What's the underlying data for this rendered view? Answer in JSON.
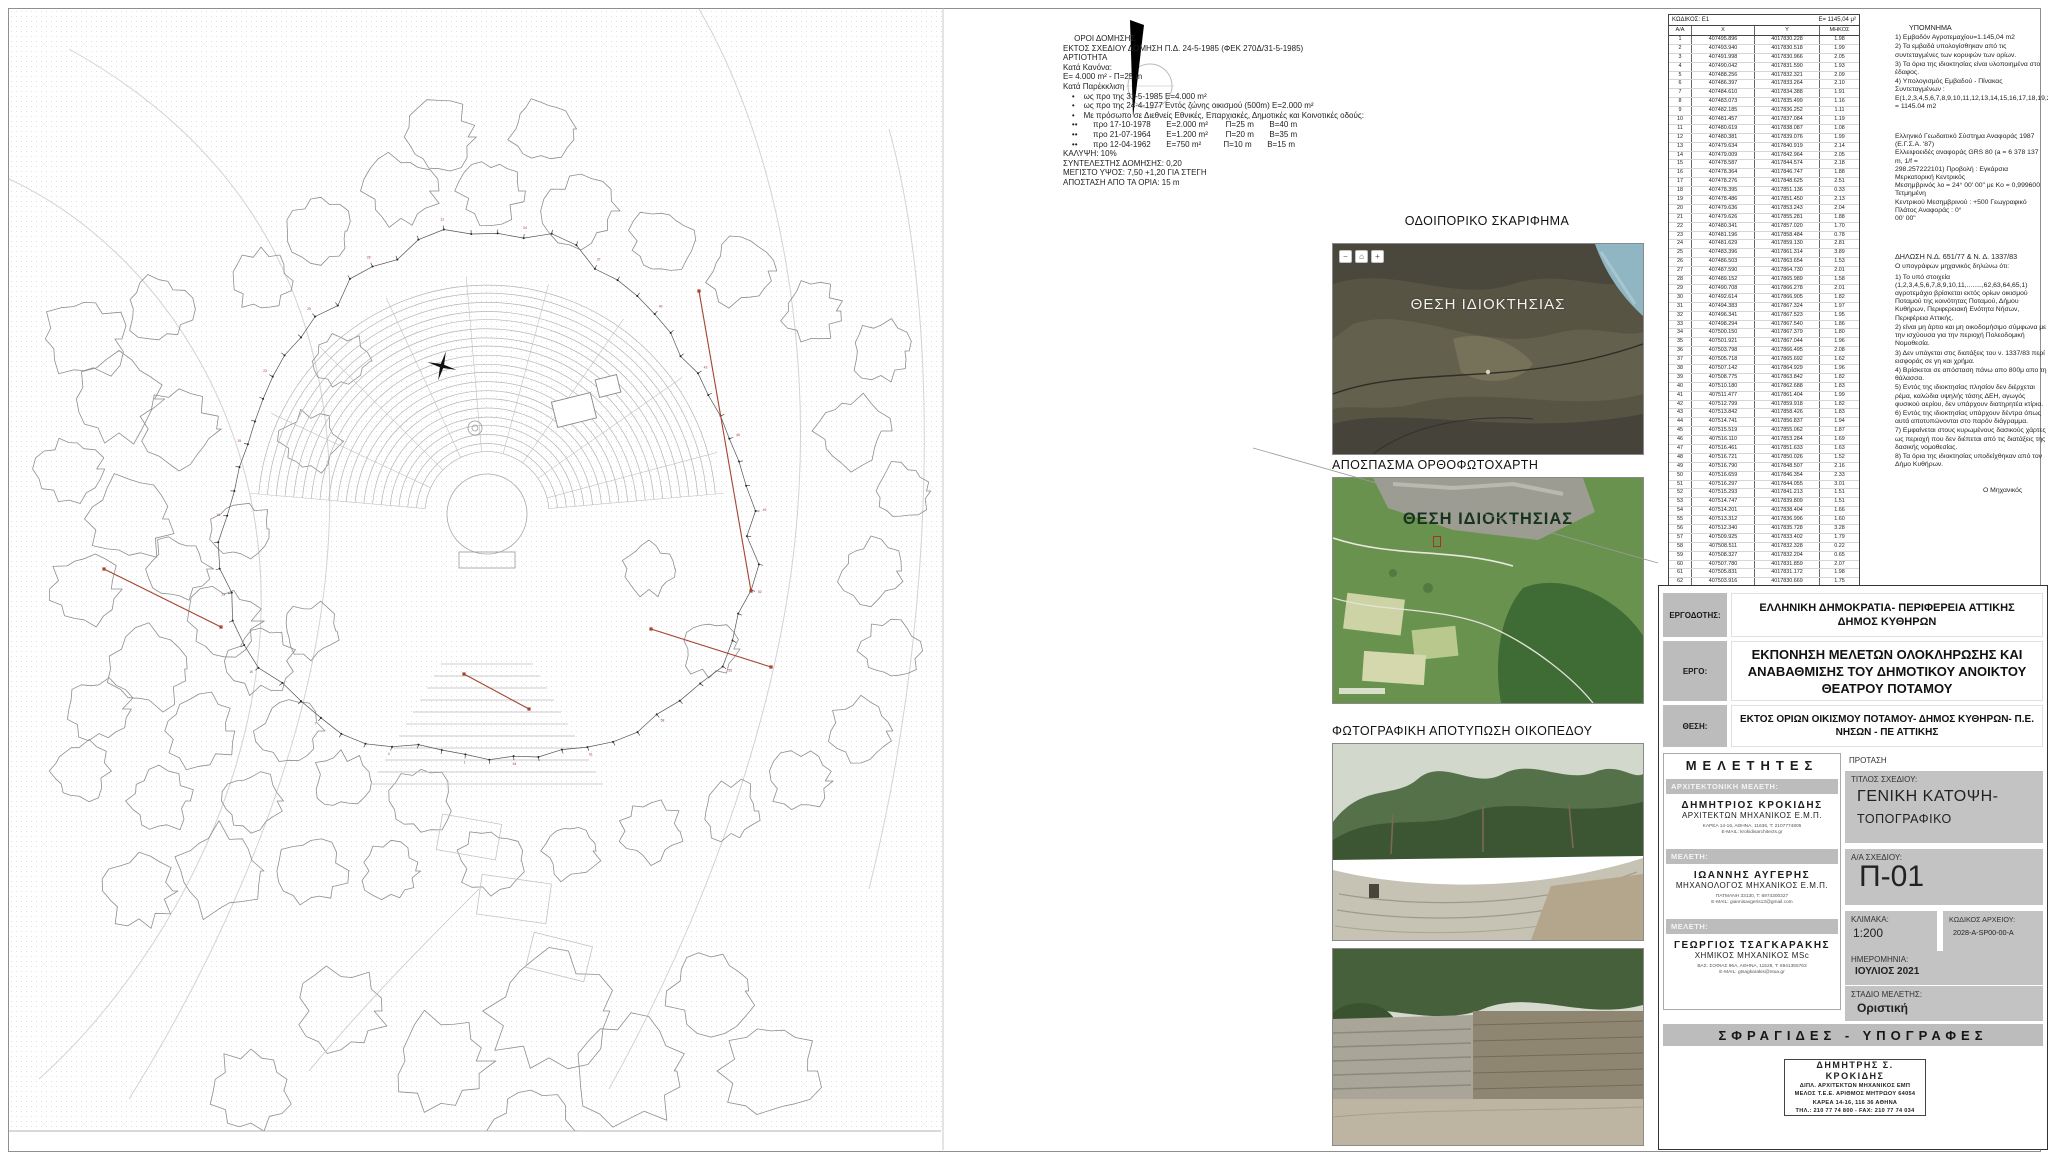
{
  "regulations": {
    "lines": [
      "     ΟΡΟΙ ΔΟΜΗΣΗΣ",
      "ΕΚΤΟΣ ΣΧΕΔΙΟΥ ΔΟΜΗΣΗ Π.Δ. 24-5-1985 (ΦΕΚ 270Δ/31-5-1985)",
      "ΑΡΤΙΟΤΗΤΑ",
      "Κατά Κανόνα:",
      "Ε= 4.000 m² - Π=25 m",
      "Κατά Παρέκκλιση",
      "    •    ως προ της 31-5-1985 Ε=4.000 m²",
      "    •    ως προ της 24-4-1977 Εντός ζώνης οικισμού (500m) Ε=2.000 m²",
      "    •    Με πρόσωπο σε Διεθνείς Εθνικές, Επαρχιακές, Δημοτικές και Κοινοτικές οδούς:",
      "    ••       προ 17-10-1978       Ε=2.000 m²        Π=25 m       Β=40 m",
      "    ••       προ 21-07-1964       Ε=1.200 m²        Π=20 m       Β=35 m",
      "    ••       προ 12-04-1962       Ε=750 m²          Π=10 m       Β=15 m",
      "",
      "ΚΑΛΥΨΗ: 10%",
      "",
      "ΣΥΝΤΕΛΕΣΤΗΣ ΔΟΜΗΣΗΣ: 0,20",
      "",
      "ΜΕΓΙΣΤΟ ΥΨΟΣ: 7,50 +1,20 ΓΙΑ ΣΤΕΓΗ",
      "",
      "ΑΠΟΣΤΑΣΗ ΑΠΟ ΤΑ ΟΡΙΑ: 15 m"
    ]
  },
  "coords_table": {
    "code_label": "ΚΩΔΙΚΟΣ: Ε1",
    "area_label": "Ε= 1145,04 μ²",
    "columns": [
      "Α/Α",
      "Χ",
      "Υ",
      "ΜΗΚΟΣ"
    ],
    "rows": [
      [
        "1",
        "407495.896",
        "4017830.228",
        "1.98"
      ],
      [
        "2",
        "407493.940",
        "4017830.518",
        "1.99"
      ],
      [
        "3",
        "407491.998",
        "4017830.966",
        "2.05"
      ],
      [
        "4",
        "407490.042",
        "4017831.590",
        "1.93"
      ],
      [
        "5",
        "407488.256",
        "4017832.321",
        "2.09"
      ],
      [
        "6",
        "407486.397",
        "4017833.264",
        "2.10"
      ],
      [
        "7",
        "407484.610",
        "4017834.388",
        "1.91"
      ],
      [
        "8",
        "407483.073",
        "4017835.499",
        "1.16"
      ],
      [
        "9",
        "407482.185",
        "4017836.252",
        "1.11"
      ],
      [
        "10",
        "407481.457",
        "4017837.084",
        "1.19"
      ],
      [
        "11",
        "407480.619",
        "4017838.087",
        "1.08"
      ],
      [
        "12",
        "407480.381",
        "4017839.076",
        "1.99"
      ],
      [
        "13",
        "407479.634",
        "4017840.919",
        "2.14"
      ],
      [
        "14",
        "407479.009",
        "4017842.964",
        "2.05"
      ],
      [
        "15",
        "407478.587",
        "4017844.574",
        "2.18"
      ],
      [
        "16",
        "407478.364",
        "4017846.747",
        "1.88"
      ],
      [
        "17",
        "407478.276",
        "4017848.625",
        "2.51"
      ],
      [
        "18",
        "407478.395",
        "4017851.136",
        "0.33"
      ],
      [
        "19",
        "407478.486",
        "4017851.450",
        "2.13"
      ],
      [
        "20",
        "407479.636",
        "4017853.243",
        "2.04"
      ],
      [
        "21",
        "407479.626",
        "4017855.281",
        "1.88"
      ],
      [
        "22",
        "407480.341",
        "4017857.020",
        "1.70"
      ],
      [
        "23",
        "407481.196",
        "4017858.484",
        "0.78"
      ],
      [
        "24",
        "407481.629",
        "4017859.130",
        "2.81"
      ],
      [
        "25",
        "407483.396",
        "4017861.314",
        "3.89"
      ],
      [
        "26",
        "407486.503",
        "4017863.654",
        "1.53"
      ],
      [
        "27",
        "407487.590",
        "4017864.730",
        "2.01"
      ],
      [
        "28",
        "407489.152",
        "4017865.989",
        "1.58"
      ],
      [
        "29",
        "407490.708",
        "4017866.278",
        "2.01"
      ],
      [
        "30",
        "407492.614",
        "4017866.905",
        "1.82"
      ],
      [
        "31",
        "407494.383",
        "4017867.324",
        "1.97"
      ],
      [
        "32",
        "407496.341",
        "4017867.523",
        "1.95"
      ],
      [
        "33",
        "407498.294",
        "4017867.540",
        "1.86"
      ],
      [
        "34",
        "407500.150",
        "4017867.379",
        "1.80"
      ],
      [
        "35",
        "407501.921",
        "4017867.044",
        "1.96"
      ],
      [
        "36",
        "407503.798",
        "4017866.495",
        "2.08"
      ],
      [
        "37",
        "407505.718",
        "4017865.692",
        "1.62"
      ],
      [
        "38",
        "407507.142",
        "4017864.929",
        "1.96"
      ],
      [
        "39",
        "407508.775",
        "4017863.842",
        "1.82"
      ],
      [
        "40",
        "407510.180",
        "4017862.688",
        "1.83"
      ],
      [
        "41",
        "407511.477",
        "4017861.404",
        "1.99"
      ],
      [
        "42",
        "407512.799",
        "4017859.918",
        "1.82"
      ],
      [
        "43",
        "407513.842",
        "4017858.426",
        "1.83"
      ],
      [
        "44",
        "407514.741",
        "4017856.837",
        "1.94"
      ],
      [
        "45",
        "407515.519",
        "4017855.062",
        "1.87"
      ],
      [
        "46",
        "407516.110",
        "4017853.284",
        "1.69"
      ],
      [
        "47",
        "407516.461",
        "4017851.633",
        "1.63"
      ],
      [
        "48",
        "407516.721",
        "4017850.026",
        "1.52"
      ],
      [
        "49",
        "407516.790",
        "4017848.507",
        "2.16"
      ],
      [
        "50",
        "407516.659",
        "4017846.354",
        "2.33"
      ],
      [
        "51",
        "407516.297",
        "4017844.055",
        "3.01"
      ],
      [
        "52",
        "407515.293",
        "4017841.213",
        "1.51"
      ],
      [
        "53",
        "407514.747",
        "4017839.809",
        "1.51"
      ],
      [
        "54",
        "407514.201",
        "4017838.404",
        "1.66"
      ],
      [
        "55",
        "407513.312",
        "4017836.996",
        "1.60"
      ],
      [
        "56",
        "407512.340",
        "4017835.728",
        "3.28"
      ],
      [
        "57",
        "407509.925",
        "4017833.402",
        "1.79"
      ],
      [
        "58",
        "407508.511",
        "4017832.328",
        "0.22"
      ],
      [
        "59",
        "407508.327",
        "4017832.204",
        "0.65"
      ],
      [
        "60",
        "407507.780",
        "4017831.859",
        "2.07"
      ],
      [
        "61",
        "407505.831",
        "4017831.172",
        "1.98"
      ],
      [
        "62",
        "407503.916",
        "4017830.669",
        "1.75"
      ],
      [
        "63",
        "407502.194",
        "4017830.352",
        "2.17"
      ],
      [
        "64",
        "407500.040",
        "4017830.129",
        "2.02"
      ],
      [
        "65",
        "407498.016",
        "4017830.001",
        "2.13"
      ]
    ]
  },
  "legend": {
    "title": "ΥΠΟΜΝΗΜΑ",
    "items": [
      "1)  Εμβαδόν Αγροτεμαχίου=1.145,04 m2",
      "2)  Τα εμβαδά υπολογίσθηκαν από τις συντεταγμένες των κορυφών των ορίων.",
      "3)  Τα όρια της ιδιοκτησίας είναι υλοποιημένα στο έδαφος.",
      "4)  Υπολογισμός Εμβαδού - Πίνακας Συντεταγμένων : Ε(1,2,3,4,5,6,7,8,9,10,11,12,13,14,15,16,17,18,19,20,21,22,23,24,25,26,27,28,29,30,31,32,33,34,35,36,37,38,39,40,41,42,43,44,45,46,47,48,49,50,51,52,53,54,55,56,57,58,59,60,61,62,63,64,65,1) = 1145.04 m2"
    ]
  },
  "geodetic": {
    "lines": [
      "Ελληνικό Γεωδαιτικό Σύστημα Αναφοράς 1987 (Ε.Γ.Σ.Α. '87)",
      "Ελλειψοειδές αναφοράς GRS 80 (a = 6 378 137 m, 1/f =",
      "298.257222101) Προβολή : Εγκάρσια Μερκατορική Κεντρικός",
      "Μεσημβρινός λο = 24° 00' 00\" με Κο = 0,999600 Τετμημένη",
      "Κεντρικού Μεσημβρινού : +500 Γεωγραφικό Πλάτος Αναφοράς : 0°",
      "00' 00\""
    ]
  },
  "declaration": {
    "title": "ΔΗΛΩΣΗ Ν.Δ. 651/77 & Ν. Δ. 1337/83",
    "intro": "Ο υπογράφων μηχανικός δηλώνω ότι:",
    "items": [
      "1)  Το υπό στοιχεία (1,2,3,4,5,6,7,8,9,10,11,........,62,63,64,65,1) αγροτεμάχιο βρίσκεται εκτός ορίων οικισμού Ποταμού της κοινότητας Ποταμού, Δήμου Κυθήρων, Περιφερειακή Ενότητα Νήσων, Περιφέρεια Αττικής.",
      "2)  είναι μη άρτιο και μη οικοδομήσιμο σύμφωνα με την ισχύουσα για την περιοχή Πολεοδομική Νομοθεσία.",
      "3)  Δεν υπάγεται στις διατάξεις του ν. 1337/83 περί εισφοράς σε γη και χρήμα.",
      "4)  Βρίσκεται σε απόσταση πάνω απο 800μ απο τη θάλασσα.",
      "5)  Εντός της ιδιοκτησίας πλησίον δεν διέρχεται ρέμα, καλώδια υψηλής τάσης ΔΕΗ, αγωγός φυσικού αερίου, δεν υπάρχουν διατηρητέα κτίρια.",
      "6)  Εντός της ιδιοκτησίας υπάρχουν δέντρα όπως αυτά αποτυπώνονται στο παρόν διάγραμμα.",
      "7)  Εμφαίνεται στους κυρωμένους δασικούς χάρτες ως περιοχή που δεν διέπεται από τις διατάξεις της δασικής νομοθεσίας.",
      "8)  Τα όρια της ιδιοκτησίας υποδείχθηκαν από τον Δήμο Κυθήρων."
    ],
    "signoff": "Ο  Μηχανικός"
  },
  "panels": {
    "sketch_label": "ΟΔΟΙΠΟΡΙΚΟ ΣΚΑΡΙΦΗΜΑ",
    "ortho_label": "ΑΠΟΣΠΑΣΜΑ ΟΡΘΟΦΩΤΟΧΑΡΤΗ",
    "photos_label": "ΦΩΤΟΓΡΑΦΙΚΗ ΑΠΟΤΥΠΩΣΗ ΟΙΚΟΠΕΔΟΥ",
    "site_label_sat": "ΘΕΣΗ ΙΔΙΟΚΤΗΣΙΑΣ",
    "site_label_ortho": "ΘΕΣΗ ΙΔΙΟΚΤΗΣΙΑΣ",
    "map_controls": [
      "−",
      "⌂",
      "+"
    ]
  },
  "titleblock": {
    "client_label": "ΕΡΓΟΔΟΤΗΣ:",
    "client_value_1": "ΕΛΛΗΝΙΚΗ ΔΗΜΟΚΡΑΤΙΑ- ΠΕΡΙΦΕΡΕΙΑ ΑΤΤΙΚΗΣ",
    "client_value_2": "ΔΗΜΟΣ ΚΥΘΗΡΩΝ",
    "project_label": "ΕΡΓΟ:",
    "project_value": "ΕΚΠΟΝΗΣΗ ΜΕΛΕΤΩΝ ΟΛΟΚΛΗΡΩΣΗΣ ΚΑΙ ΑΝΑΒΑΘΜΙΣΗΣ ΤΟΥ ΔΗΜΟΤΙΚΟΥ ΑΝΟΙΚΤΟΥ ΘΕΑΤΡΟΥ ΠΟΤΑΜΟΥ",
    "location_label": "ΘΕΣΗ:",
    "location_value": "ΕΚΤΟΣ ΟΡΙΩΝ ΟΙΚΙΣΜΟΥ ΠΟΤΑΜΟΥ- ΔΗΜΟΣ ΚΥΘΗΡΩΝ- Π.Ε. ΝΗΣΩΝ - ΠΕ ΑΤΤΙΚΗΣ",
    "designers": {
      "header": "ΜΕΛΕΤΗΤΕΣ",
      "entries": [
        {
          "role": "ΑΡΧΙΤΕΚΤΟΝΙΚΗ ΜΕΛΕΤΗ:",
          "name": "ΔΗΜΗΤΡΙΟΣ ΚΡΟΚΙΔΗΣ",
          "title": "ΑΡΧΙΤΕΚΤΩΝ ΜΗΧΑΝΙΚΟΣ Ε.Μ.Π.",
          "address": "ΚΑΡΕΑ 14-16, ΑΘΗΝΑ, 11636, Τ: 2107774805",
          "email": "E-MAIL: krokidisarchitects.gr"
        },
        {
          "role": "ΜΕΛΕΤΗ:",
          "name": "ΙΩΑΝΝΗΣ ΑΥΓΕΡΗΣ",
          "title": "ΜΗΧΑΝΟΛΟΓΟΣ ΜΗΧΑΝΙΚΟΣ Ε.Μ.Π.",
          "address": "ΠΑΤΜΑΝΗ 33130, Τ: 6974300327",
          "email": "E-MAIL: giannisavgeris13@gmail.com"
        },
        {
          "role": "ΜΕΛΕΤΗ:",
          "name": "ΓΕΩΡΓΙΟΣ ΤΣΑΓΚΑΡΑΚΗΣ",
          "title": "ΧΗΜΙΚΟΣ ΜΗΧΑΝΙΚΟΣ MSc",
          "address": "ΒΑΣ. ΣΟΦΙΑΣ 96Α, ΑΘΗΝΑ, 11528, Τ: 6941355763",
          "email": "E-MAIL: gtsagkarakis@ntua.gr"
        }
      ]
    },
    "proposal_label": "ΠΡΟΤΑΣΗ",
    "sheet_title_label": "ΤΙΤΛΟΣ ΣΧΕΔΙΟΥ:",
    "sheet_title_1": "ΓΕΝΙΚΗ ΚΑΤΟΨΗ-",
    "sheet_title_2": "ΤΟΠΟΓΡΑΦΙΚΟ",
    "sheet_no_label": "Α/Α ΣΧΕΔΙΟΥ:",
    "sheet_no": "Π-01",
    "scale_label": "ΚΛΙΜΑΚΑ:",
    "scale": "1:200",
    "file_code_label": "ΚΩΔΙΚΟΣ ΑΡΧΕΙΟΥ:",
    "file_code": "2028-A-SP00-00-A",
    "date_label": "ΗΜΕΡΟΜΗΝΙΑ:",
    "date": "ΙΟΥΛΙΟΣ 2021",
    "stage_label": "ΣΤΑΔΙΟ ΜΕΛΕΤΗΣ:",
    "stage": "Οριστική",
    "stamps_header": "ΣΦΡΑΓΙΔΕΣ - ΥΠΟΓΡΑΦΕΣ",
    "stamp": {
      "lines": [
        "ΔΗΜΗΤΡΗΣ Σ. ΚΡΟΚΙΔΗΣ",
        "ΔΙΠΛ. ΑΡΧΙΤΕΚΤΩΝ ΜΗΧΑΝΙΚΟΣ ΕΜΠ",
        "ΜΕΛΟΣ Τ.Ε.Ε. ΑΡΙΘΜΟΣ ΜΗΤΡΩΟΥ 64054",
        "ΚΑΡΕΑ 14-16, 116 36 ΑΘΗΝΑ",
        "ΤΗΛ.: 210 77 74 800 - FAX: 210 77 74 034"
      ]
    }
  },
  "colors": {
    "survey_red": "#a5442f",
    "plan_gray": "#b5b5b5",
    "panel_gray": "#bcbcbc"
  }
}
